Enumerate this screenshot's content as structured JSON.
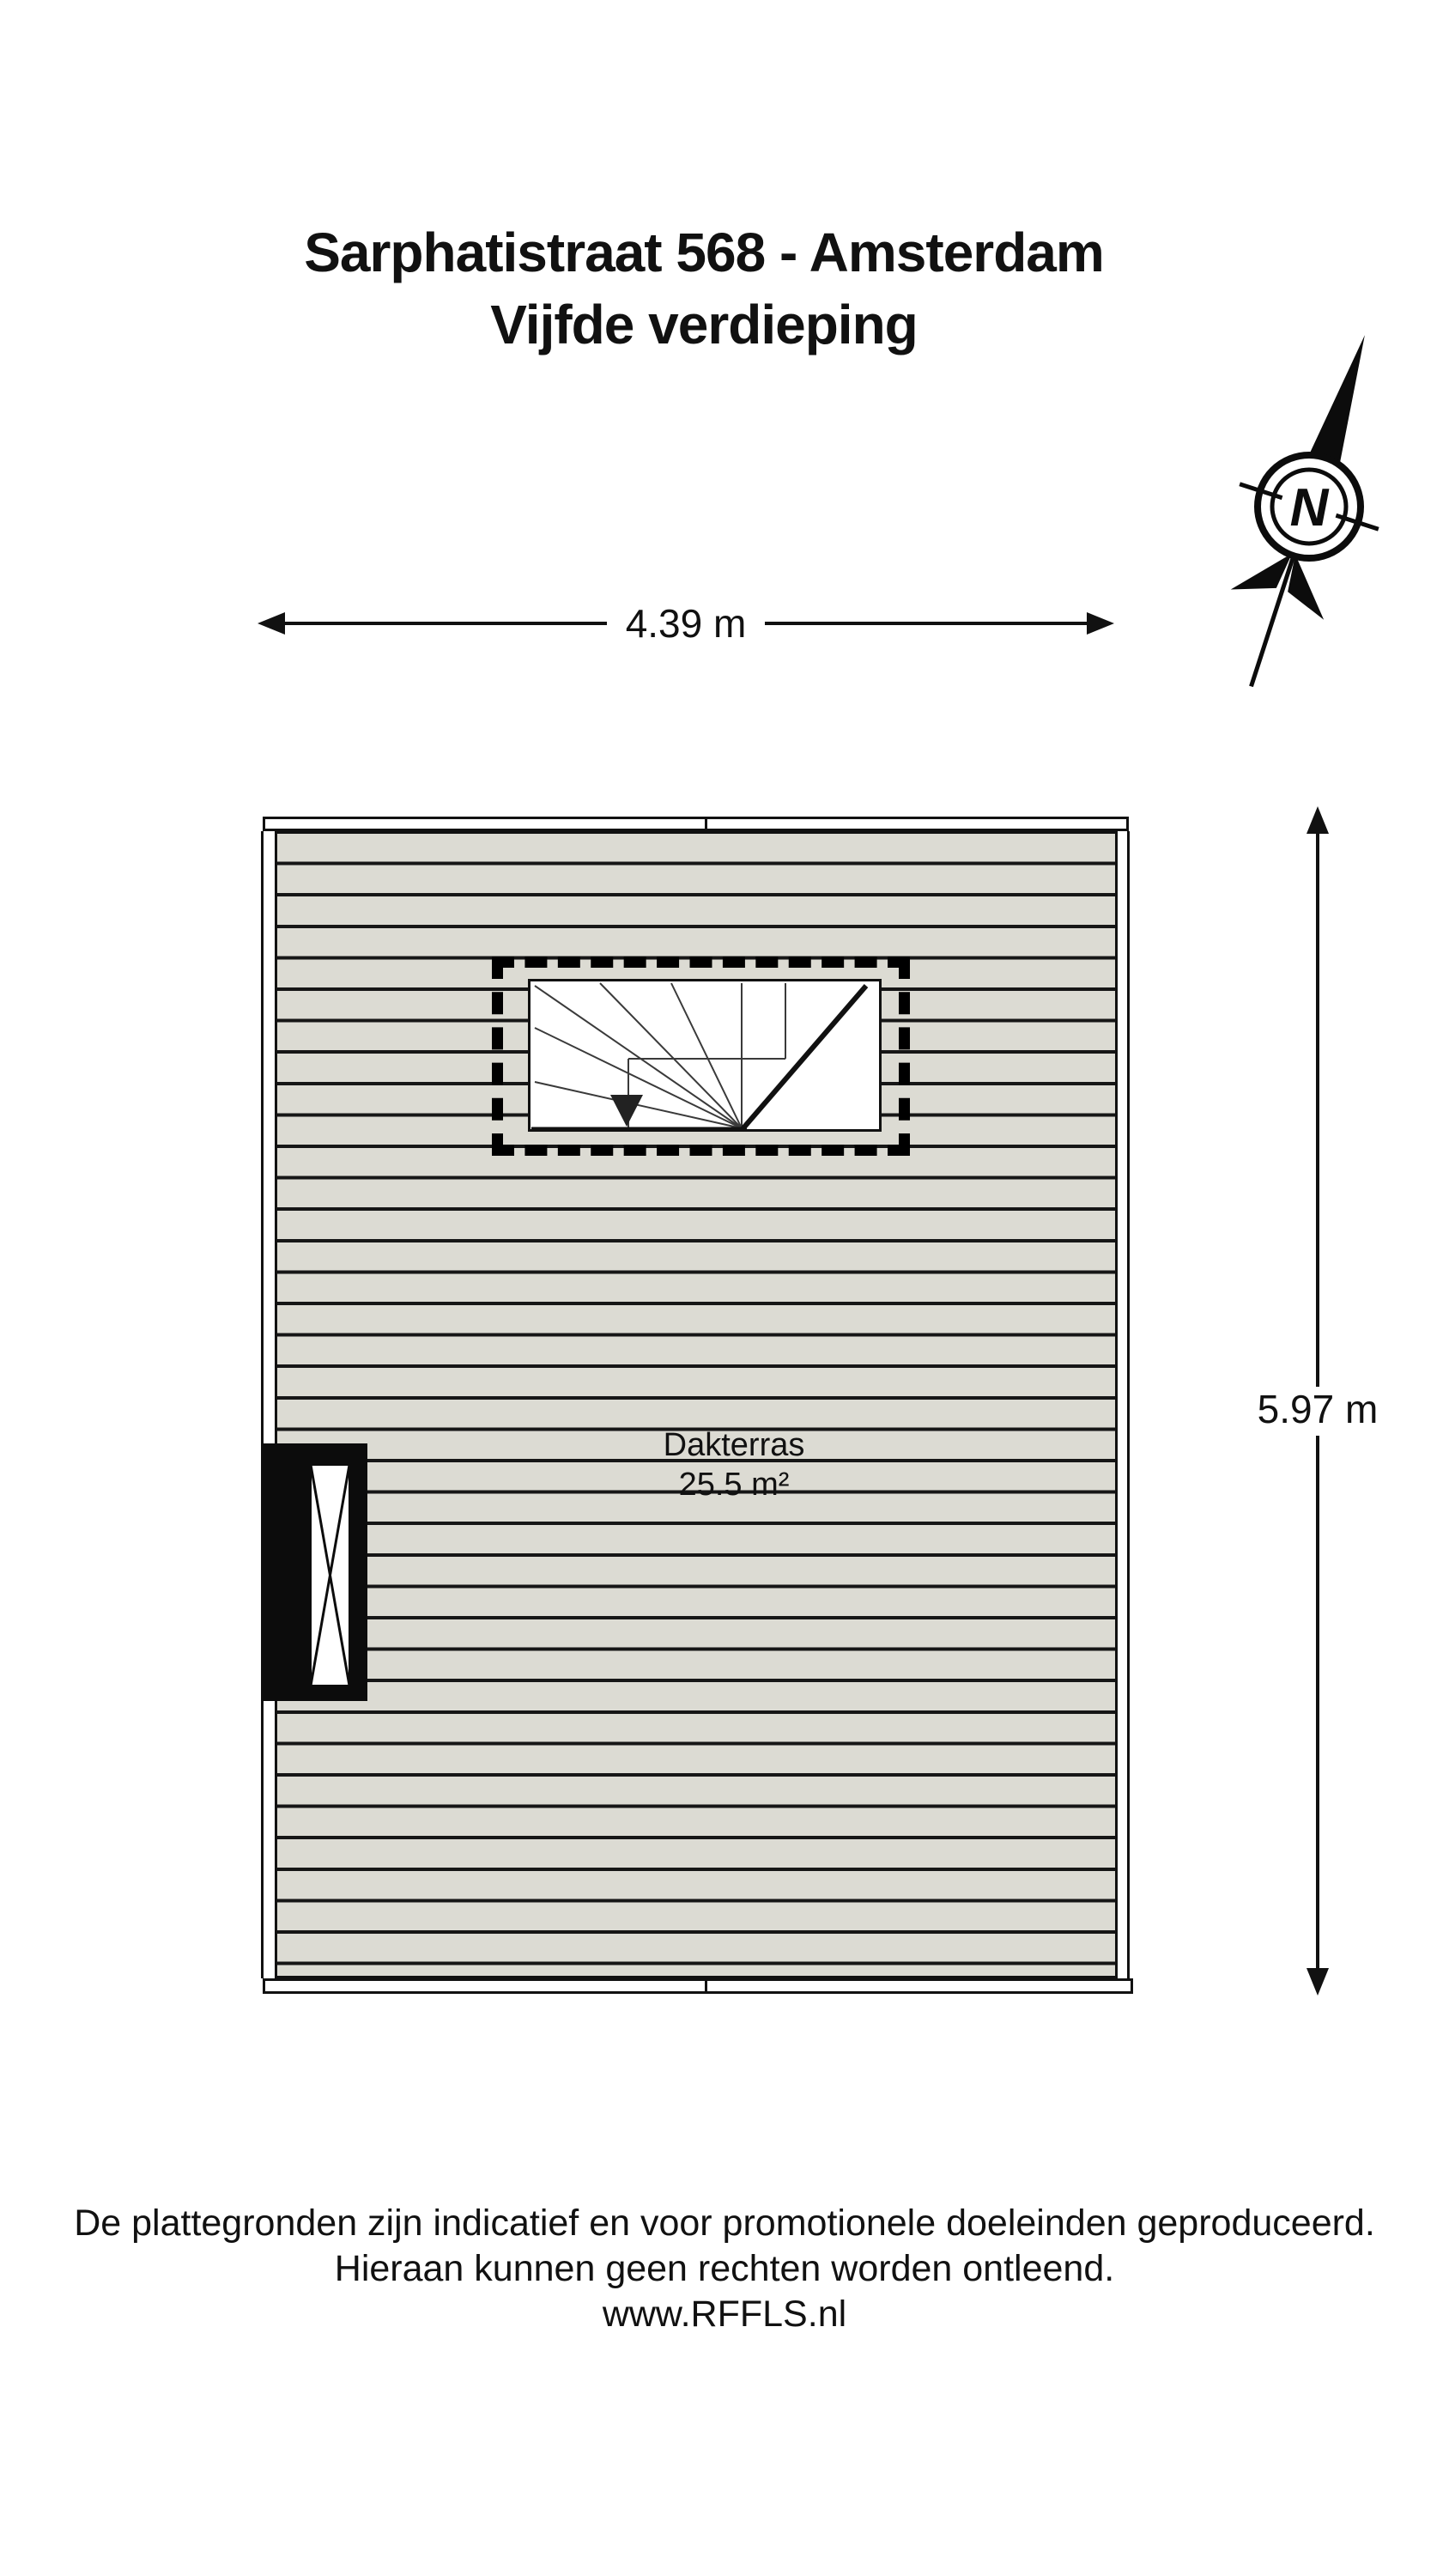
{
  "header": {
    "title_line1": "Sarphatistraat 568 - Amsterdam",
    "title_line2": "Vijfde verdieping"
  },
  "plan": {
    "room_label": "Dakterras",
    "room_area": "25.5 m²",
    "dimension_width": "4.39 m",
    "dimension_height": "5.97 m",
    "compass_label": "N"
  },
  "icons": {
    "compass_icon": "north-compass-needle",
    "stairs_icon": "winder-staircase-top-view",
    "window_icon": "roof-access-window"
  },
  "colors": {
    "deck_plank": "#dcdbd3",
    "line": "#111111",
    "background": "#ffffff"
  },
  "footer": {
    "disclaimer_line1": "De plattegronden zijn indicatief en voor promotionele doeleinden geproduceerd.",
    "disclaimer_line2": "Hieraan kunnen geen rechten worden ontleend.",
    "website": "www.RFFLS.nl"
  }
}
